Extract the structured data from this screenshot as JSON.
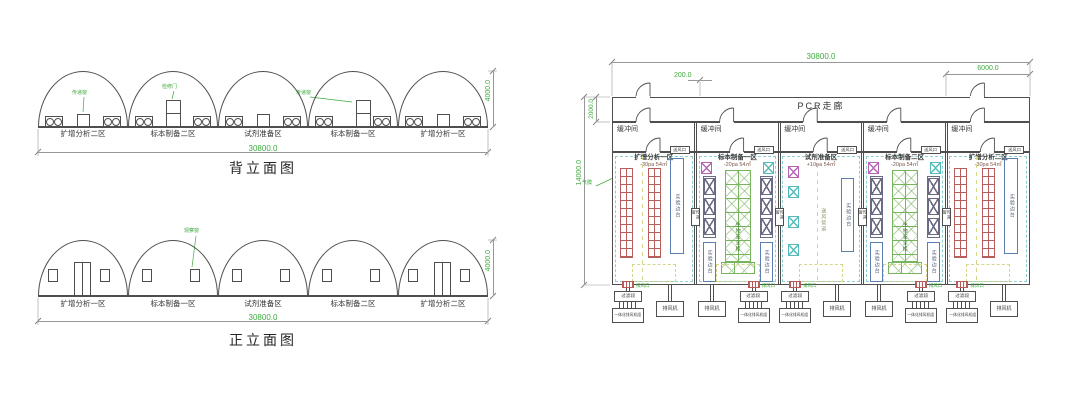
{
  "colors": {
    "line": "#4f4f4f",
    "dim_text": "#3faa3f",
    "red": "#b85c5c",
    "green": "#78b35e",
    "magenta": "#b564b5",
    "cyan": "#52bcbc",
    "blue": "#5b7db1",
    "yellow": "#d6d68a",
    "purple": "#6a6a85"
  },
  "rear_elevation": {
    "title": "背立面图",
    "total_width": "30800.0",
    "height": "4000.0",
    "zones": [
      "扩增分析二区",
      "标本制备二区",
      "试剂准备区",
      "标本制备一区",
      "扩增分析一区"
    ],
    "annotations": [
      "传递窗",
      "检修门",
      "传递窗"
    ]
  },
  "front_elevation": {
    "title": "正立面图",
    "total_width": "30800.0",
    "height": "4000.0",
    "zones": [
      "扩增分析一区",
      "标本制备一区",
      "试剂准备区",
      "标本制备二区",
      "扩增分析二区"
    ],
    "annotations": [
      "观察窗"
    ]
  },
  "floor_plan": {
    "corridor": "PCR走廊",
    "buffer": "缓冲间",
    "dims": {
      "total_width": "30800.0",
      "room_width": "6000.0",
      "offset": "200.0",
      "corridor_depth": "2000.0",
      "total_depth": "14000.0"
    },
    "labels": {
      "supply": "送风口",
      "pass": "传递窗",
      "exhaust": "排风口",
      "membrane": "气膜",
      "duct": "送风管道",
      "cabinet": "生物安全柜",
      "bench": "实验边台"
    },
    "rooms": [
      {
        "name": "扩增分析一区",
        "spec": "-30pa 54㎡",
        "type": "amplification"
      },
      {
        "name": "标本制备一区",
        "spec": "-20pa 54㎡",
        "type": "preparation"
      },
      {
        "name": "试剂准备区",
        "spec": "+10pa 54㎡",
        "type": "reagent"
      },
      {
        "name": "标本制备二区",
        "spec": "-20pa 54㎡",
        "type": "preparation"
      },
      {
        "name": "扩增分析二区",
        "spec": "-30pa 54㎡",
        "type": "amplification"
      }
    ],
    "bottom": {
      "filter": "过滤段",
      "fan": "排风机",
      "unit": "一体化排风机组",
      "sequence": [
        "filter",
        "fan",
        "fan",
        "filter",
        "filter",
        "fan",
        "fan",
        "filter",
        "filter",
        "fan"
      ]
    }
  }
}
